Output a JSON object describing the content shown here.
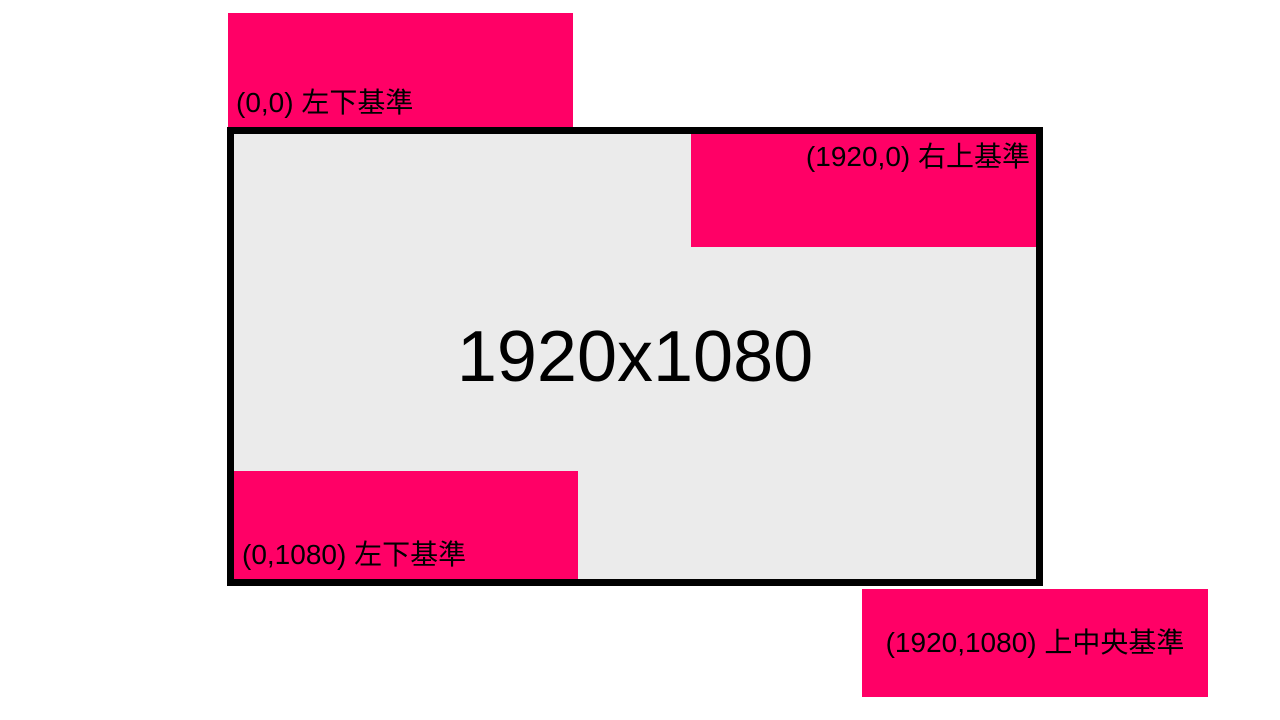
{
  "screen": {
    "resolution_label": "1920x1080",
    "fill_color": "#ebebeb",
    "border_color": "#000000"
  },
  "window_fill_color": "#ff0066",
  "windows": [
    {
      "label": "(0,0) 左下基準",
      "anchor": "bottom-left",
      "position": "above-screen-top-left"
    },
    {
      "label": "(1920,0) 右上基準",
      "anchor": "top-right",
      "position": "inside-screen-top-right"
    },
    {
      "label": "(0,1080) 左下基準",
      "anchor": "bottom-left",
      "position": "inside-screen-bottom-left"
    },
    {
      "label": "(1920,1080) 上中央基準",
      "anchor": "top-center",
      "position": "below-screen-bottom-right"
    }
  ]
}
